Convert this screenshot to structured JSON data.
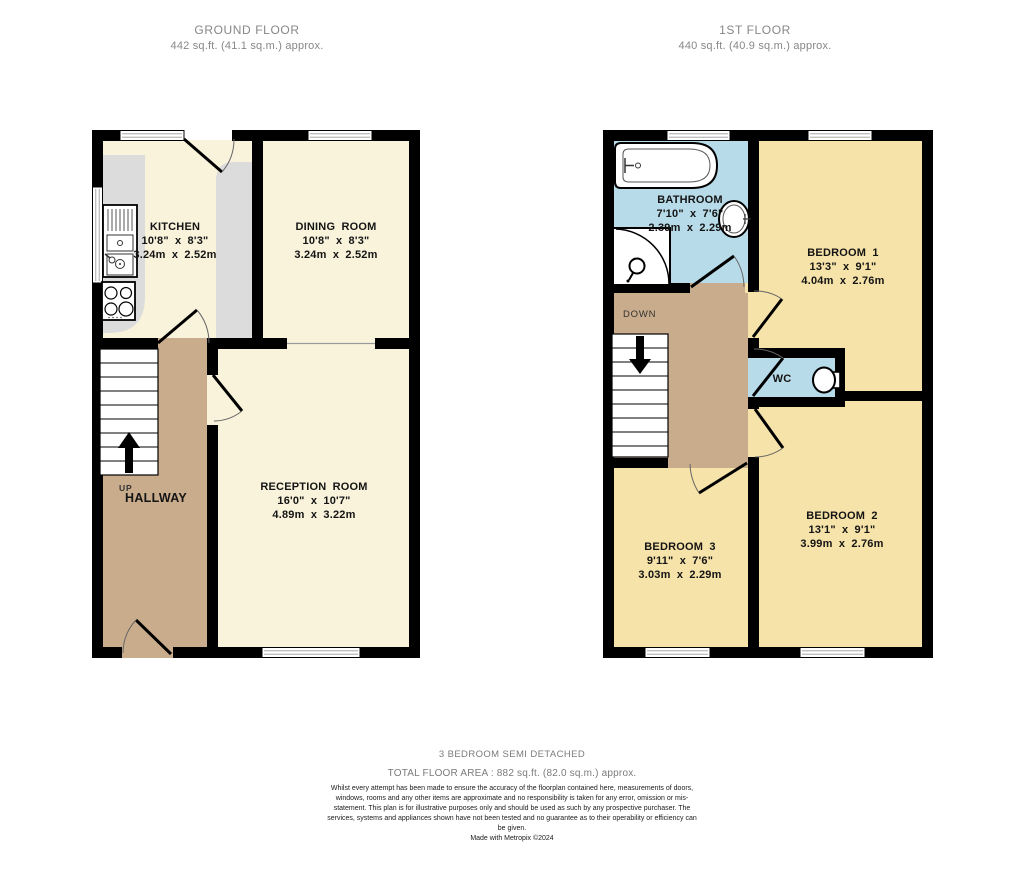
{
  "headers": {
    "ground": {
      "title": "GROUND FLOOR",
      "area": "442 sq.ft. (41.1 sq.m.) approx."
    },
    "first": {
      "title": "1ST FLOOR",
      "area": "440 sq.ft. (40.9 sq.m.) approx."
    }
  },
  "ground_floor": {
    "kitchen": {
      "name": "KITCHEN",
      "imperial": "10'8\" x 8'3\"",
      "metric": "3.24m x 2.52m"
    },
    "dining_room": {
      "name": "DINING ROOM",
      "imperial": "10'8\" x 8'3\"",
      "metric": "3.24m x 2.52m"
    },
    "reception_room": {
      "name": "RECEPTION ROOM",
      "imperial": "16'0\" x 10'7\"",
      "metric": "4.89m x 3.22m"
    },
    "hallway": {
      "name": "HALLWAY",
      "direction": "UP"
    }
  },
  "first_floor": {
    "bathroom": {
      "name": "BATHROOM",
      "imperial": "7'10\" x 7'6\"",
      "metric": "2.39m x 2.29m"
    },
    "bedroom_1": {
      "name": "BEDROOM 1",
      "imperial": "13'3\" x 9'1\"",
      "metric": "4.04m x 2.76m"
    },
    "bedroom_2": {
      "name": "BEDROOM 2",
      "imperial": "13'1\" x 9'1\"",
      "metric": "3.99m x 2.76m"
    },
    "bedroom_3": {
      "name": "BEDROOM 3",
      "imperial": "9'11\" x 7'6\"",
      "metric": "3.03m x 2.29m"
    },
    "wc": {
      "name": "WC"
    },
    "landing": {
      "direction": "DOWN"
    }
  },
  "footer": {
    "property_type": "3 BEDROOM SEMI DETACHED",
    "total_area": "TOTAL FLOOR AREA : 882 sq.ft. (82.0 sq.m.) approx.",
    "disclaimer": "Whilst every attempt has been made to ensure the accuracy of the floorplan contained here, measurements of doors, windows, rooms and any other items are approximate and no responsibility is taken for any error, omission or mis-statement. This plan is for illustrative purposes only and should be used as such by any prospective purchaser. The services, systems and appliances shown have not been tested and no guarantee as to their operability or efficiency can be given.",
    "credit": "Made with Metropix ©2024"
  },
  "palette": {
    "wall": "#000000",
    "ground_room_cream": "#f9f3dc",
    "bedroom_yellow": "#f6e3a9",
    "bathroom_blue": "#b7dbe8",
    "hall_tan": "#c9ac8c",
    "counter_gray": "#dcdcdc",
    "label_text": "#141414",
    "header_text": "#878787"
  }
}
